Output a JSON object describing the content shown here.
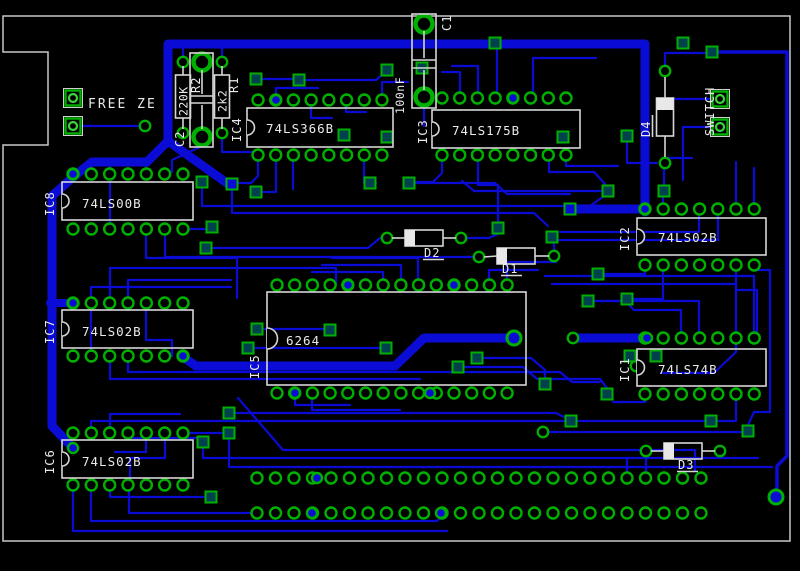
{
  "colors": {
    "background": "#000000",
    "copper_trace": "#0b0bd6",
    "pad_green": "#00b000",
    "silkscreen": "#e8e8e8",
    "board_outline": "#c8c8c8"
  },
  "ics": [
    {
      "id": "IC1",
      "part": "74LS74B"
    },
    {
      "id": "IC2",
      "part": "74LS02B"
    },
    {
      "id": "IC3",
      "part": "74LS175B"
    },
    {
      "id": "IC4",
      "part": "74LS366B"
    },
    {
      "id": "IC5",
      "part": "6264"
    },
    {
      "id": "IC6",
      "part": "74LS02B"
    },
    {
      "id": "IC7",
      "part": "74LS02B"
    },
    {
      "id": "IC8",
      "part": "74LS00B"
    }
  ],
  "resistors": [
    {
      "id": "R1",
      "value": "2k2"
    },
    {
      "id": "R2",
      "value": "220K"
    }
  ],
  "capacitors": [
    {
      "id": "C1",
      "value": "100nF"
    },
    {
      "id": "C2",
      "value": ""
    }
  ],
  "diodes": [
    {
      "id": "D1"
    },
    {
      "id": "D2"
    },
    {
      "id": "D3"
    },
    {
      "id": "D4"
    }
  ],
  "labels": {
    "freeze": "FREE ZE",
    "switch": "SWITCH"
  }
}
